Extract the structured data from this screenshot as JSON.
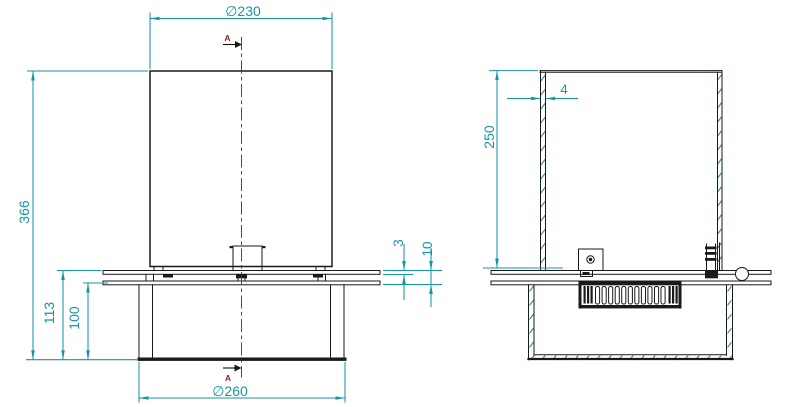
{
  "colors": {
    "dim": "#1795a5",
    "line": "#1a1a1a",
    "hatch": "#2f8f96",
    "section": "#9b1c1c"
  },
  "front_view": {
    "label_dia_top": "∅230",
    "label_height_total": "366",
    "label_height_plate": "113",
    "label_height_tank": "100",
    "label_plate_thickness": "3",
    "label_plate_assembly": "10",
    "label_dia_base": "∅260",
    "section_letter_top": "A",
    "section_letter_bottom": "A"
  },
  "section_view": {
    "label_height": "250",
    "label_wall_thickness": "4"
  }
}
